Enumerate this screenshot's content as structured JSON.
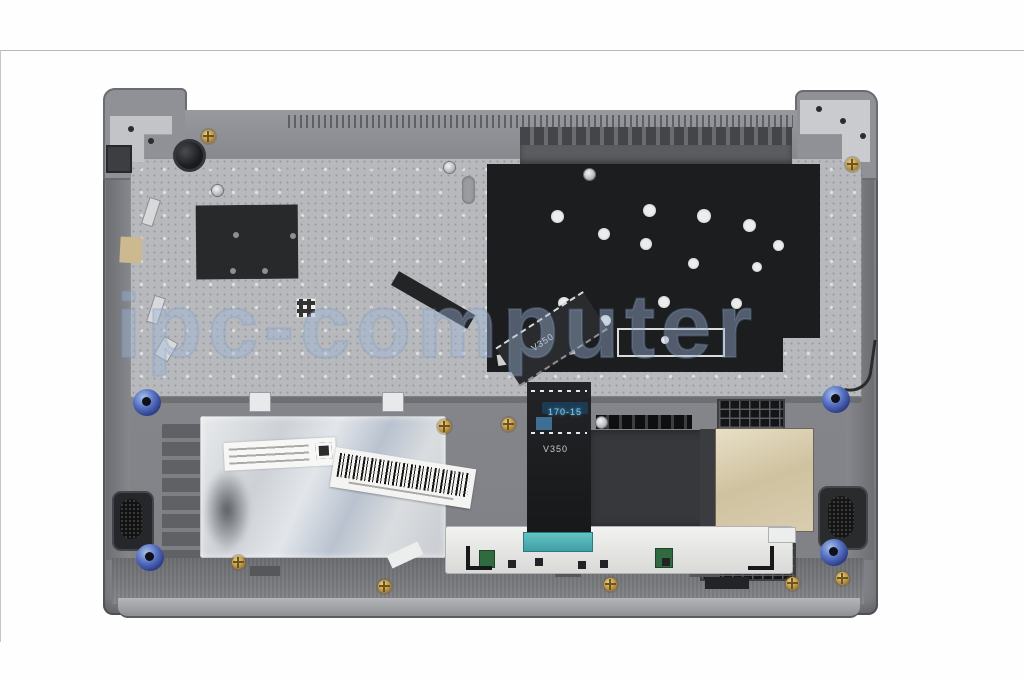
{
  "image": {
    "type": "product-photo",
    "subject": "laptop palmrest keyboard assembly, internal bottom view",
    "background_color": "#ffffff"
  },
  "watermark": {
    "text": "ipc-computer",
    "color": "#9db4d6"
  },
  "stickers": {
    "flex_cable_label_top": "V350",
    "flex_cable_tag": "170-15",
    "flex_cable_label_bottom": "V350"
  },
  "colors": {
    "body_gray": "#85878c",
    "plate_silver": "#b7b9bc",
    "mylar_black": "#1c1d1f",
    "teal_connector": "#4fb3b5",
    "grommet_blue": "#4a63b4",
    "gold_foil": "#d6c9a8"
  }
}
